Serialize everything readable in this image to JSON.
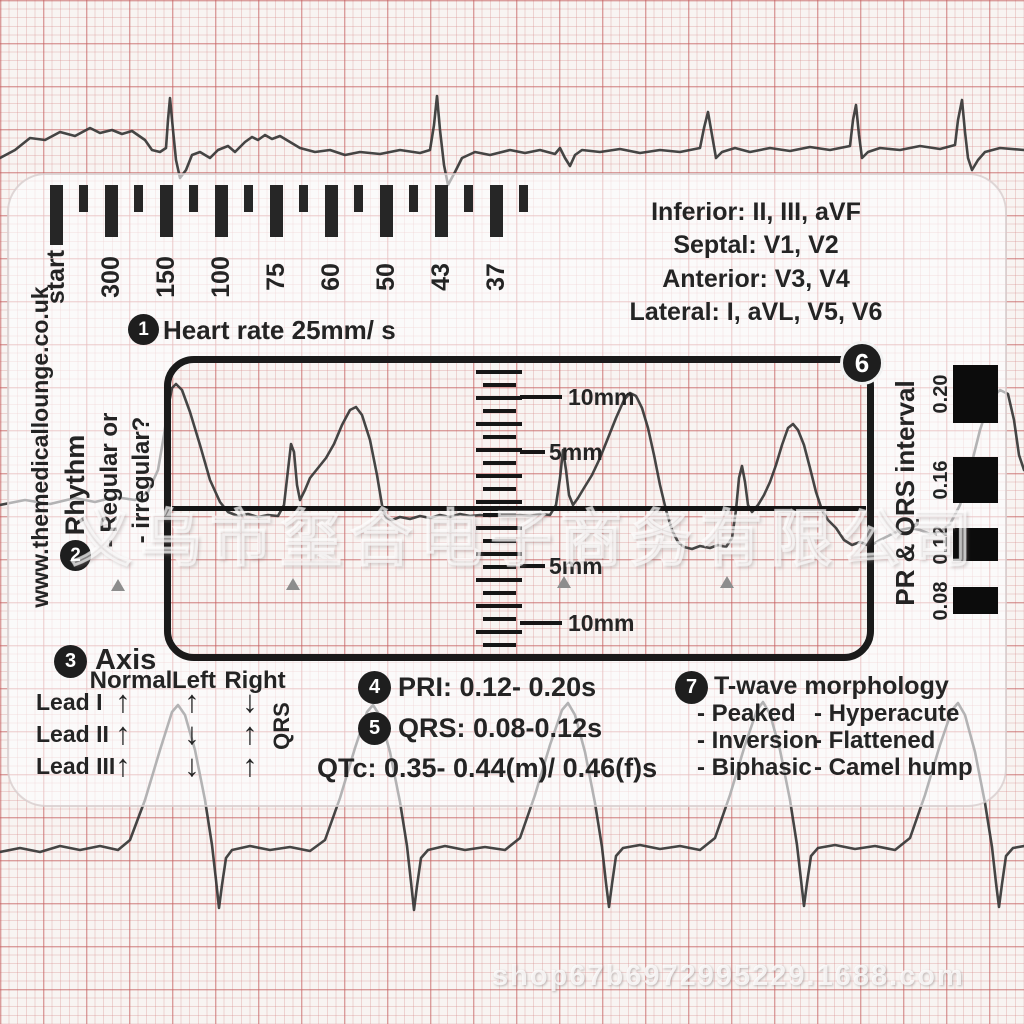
{
  "watermarks": {
    "center": "义乌市玺合电子商务有限公司",
    "bottom": "shop67b6972995229.1688.com"
  },
  "card": {
    "brand": "www.themedicallounge.co.uk",
    "heart_rate": {
      "step": "1",
      "label": "Heart rate 25mm/ s"
    },
    "ruler_labels": [
      "start",
      "300",
      "150",
      "100",
      "75",
      "60",
      "50",
      "43",
      "37"
    ],
    "lead_groups": [
      "Inferior: II, III, aVF",
      "Septal: V1, V2",
      "Anterior: V3, V4",
      "Lateral: I, aVL, V5, V6"
    ],
    "rhythm": {
      "step": "2",
      "label": "Rhythm",
      "options": [
        "- Regular or",
        "- irregular?"
      ]
    },
    "window": {
      "step": "6",
      "scale_labels": [
        "10mm",
        "5mm",
        "5mm",
        "10mm"
      ]
    },
    "pr_qrs": {
      "label": "PR & QRS interval",
      "values": [
        "0.20",
        "0.16",
        "0.12",
        "0.08"
      ]
    },
    "axis": {
      "step": "3",
      "label": "Axis",
      "qrs": "QRS",
      "columns": [
        "Normal",
        "Left",
        "Right"
      ],
      "rows": [
        {
          "lead": "Lead I",
          "dirs": [
            "up",
            "up",
            "down"
          ]
        },
        {
          "lead": "Lead II",
          "dirs": [
            "up",
            "down",
            "up"
          ]
        },
        {
          "lead": "Lead III",
          "dirs": [
            "up",
            "down",
            "up"
          ]
        }
      ]
    },
    "intervals": {
      "pri_step": "4",
      "pri": "PRI: 0.12- 0.20s",
      "qrs_step": "5",
      "qrs": "QRS: 0.08-0.12s",
      "qtc": "QTc: 0.35- 0.44(m)/ 0.46(f)s"
    },
    "t_wave": {
      "step": "7",
      "title": "T-wave morphology",
      "left": [
        "- Peaked",
        "- Inversion",
        "- Biphasic"
      ],
      "right": [
        "- Hyperacute",
        "- Flattened",
        "- Camel hump"
      ]
    }
  },
  "colors": {
    "ink": "#242424",
    "paper_grid": "#c45c5c",
    "trace": "#353535",
    "block": "#0c0c0c"
  }
}
